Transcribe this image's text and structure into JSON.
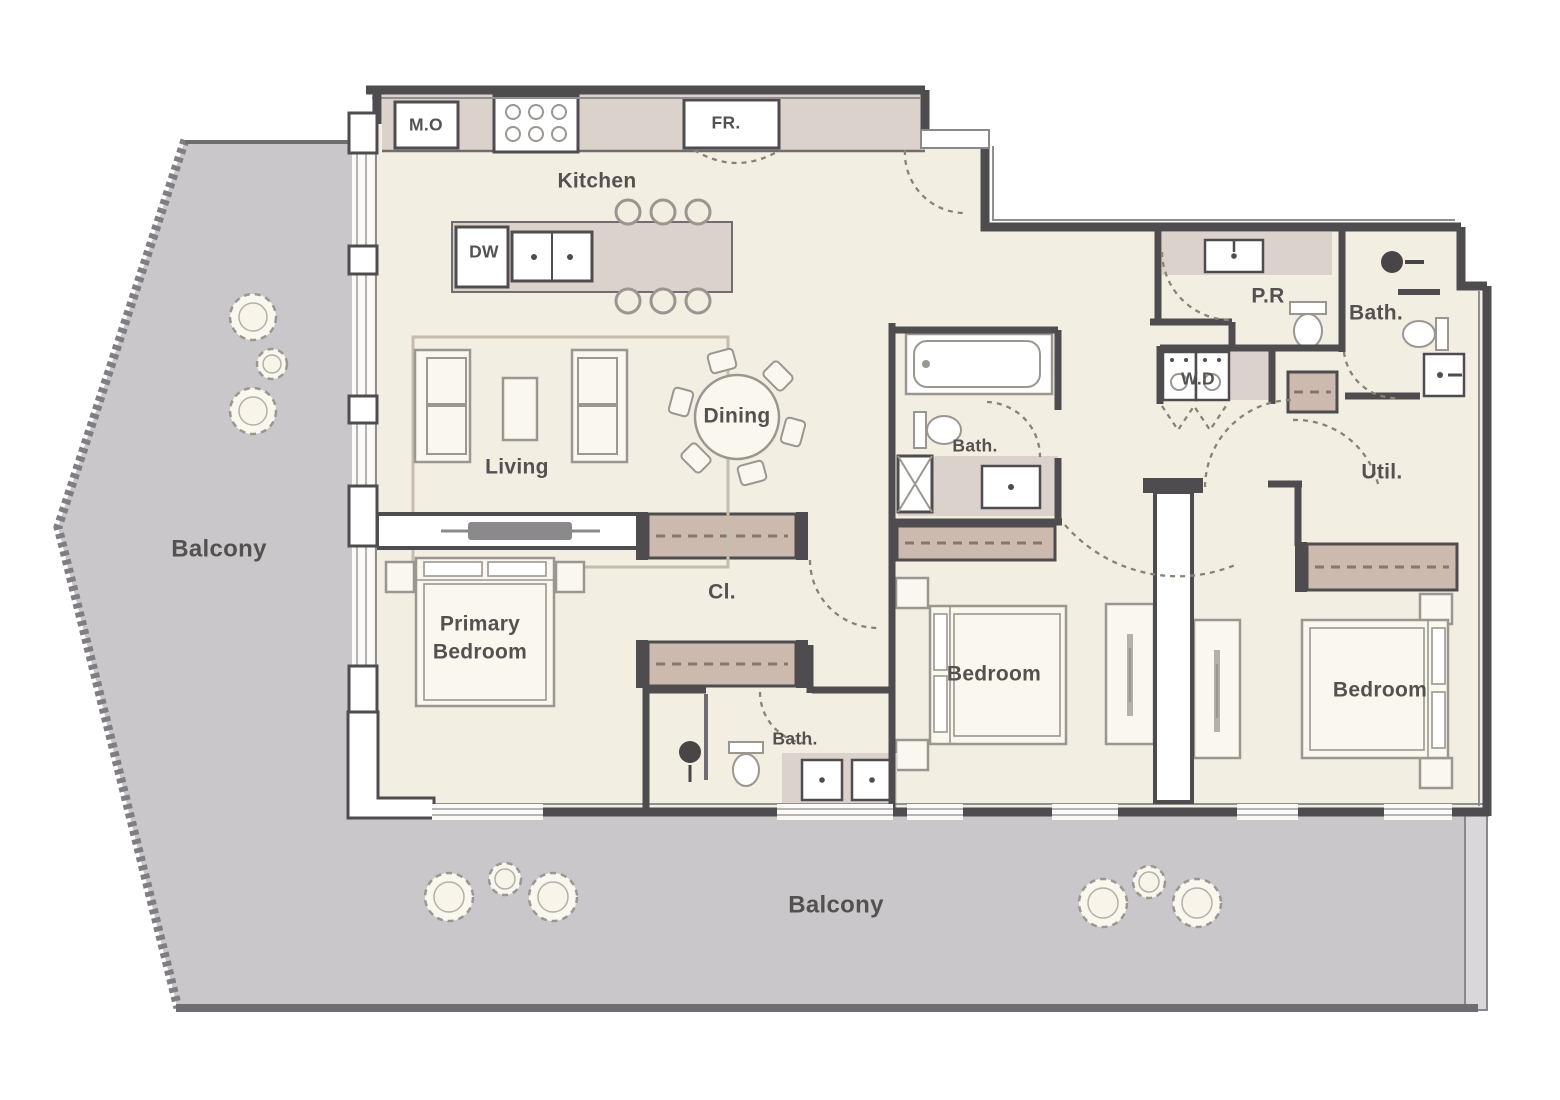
{
  "colors": {
    "floor": "#f3eee2",
    "balcony": "#c9c7ca",
    "balconyEdge": "#807e82",
    "balconyDark": "#6f6d71",
    "wall": "#4e4c4e",
    "wallLight": "#908e91",
    "glass": "#adaaad",
    "case": "#dcd2cc",
    "caseLine": "#6f6d71",
    "wardrobe": "#ccbaaf",
    "dashBrown": "#8a7568",
    "furnFill": "#faf7ee",
    "furnLine": "#9b9690",
    "console": "#8b898c",
    "label": "#555150",
    "door": "#8b8174",
    "drain": "#474545"
  },
  "plan": {
    "labels": [
      {
        "id": "kitchen",
        "text": "Kitchen",
        "x": 597,
        "y": 182,
        "size": "md"
      },
      {
        "id": "microwave-oven-tag",
        "text": "M.O",
        "x": 426,
        "y": 126,
        "size": "sm"
      },
      {
        "id": "fridge-tag",
        "text": "FR.",
        "x": 726,
        "y": 124,
        "size": "sm"
      },
      {
        "id": "dishwasher-tag",
        "text": "DW",
        "x": 484,
        "y": 253,
        "size": "sm"
      },
      {
        "id": "dining",
        "text": "Dining",
        "x": 737,
        "y": 417,
        "size": "md"
      },
      {
        "id": "living",
        "text": "Living",
        "x": 517,
        "y": 468,
        "size": "md"
      },
      {
        "id": "balcony-left",
        "text": "Balcony",
        "x": 219,
        "y": 550,
        "size": "lg"
      },
      {
        "id": "balcony-bottom",
        "text": "Balcony",
        "x": 836,
        "y": 906,
        "size": "lg"
      },
      {
        "id": "powder-room",
        "text": "P.R",
        "x": 1268,
        "y": 297,
        "size": "md"
      },
      {
        "id": "bath-top-right",
        "text": "Bath.",
        "x": 1376,
        "y": 314,
        "size": "md"
      },
      {
        "id": "washer-dryer",
        "text": "W.D",
        "x": 1198,
        "y": 380,
        "size": "sm"
      },
      {
        "id": "utility",
        "text": "Util.",
        "x": 1382,
        "y": 473,
        "size": "md"
      },
      {
        "id": "bath-middle",
        "text": "Bath.",
        "x": 975,
        "y": 447,
        "size": "sm"
      },
      {
        "id": "closet",
        "text": "Cl.",
        "x": 722,
        "y": 593,
        "size": "md"
      },
      {
        "id": "primary-bedroom-line1",
        "text": "Primary",
        "x": 480,
        "y": 625,
        "size": "md"
      },
      {
        "id": "primary-bedroom-line2",
        "text": "Bedroom",
        "x": 480,
        "y": 653,
        "size": "md"
      },
      {
        "id": "bedroom-middle",
        "text": "Bedroom",
        "x": 994,
        "y": 675,
        "size": "md"
      },
      {
        "id": "bedroom-right",
        "text": "Bedroom",
        "x": 1380,
        "y": 691,
        "size": "md"
      },
      {
        "id": "bath-primary",
        "text": "Bath.",
        "x": 795,
        "y": 740,
        "size": "sm"
      }
    ]
  }
}
